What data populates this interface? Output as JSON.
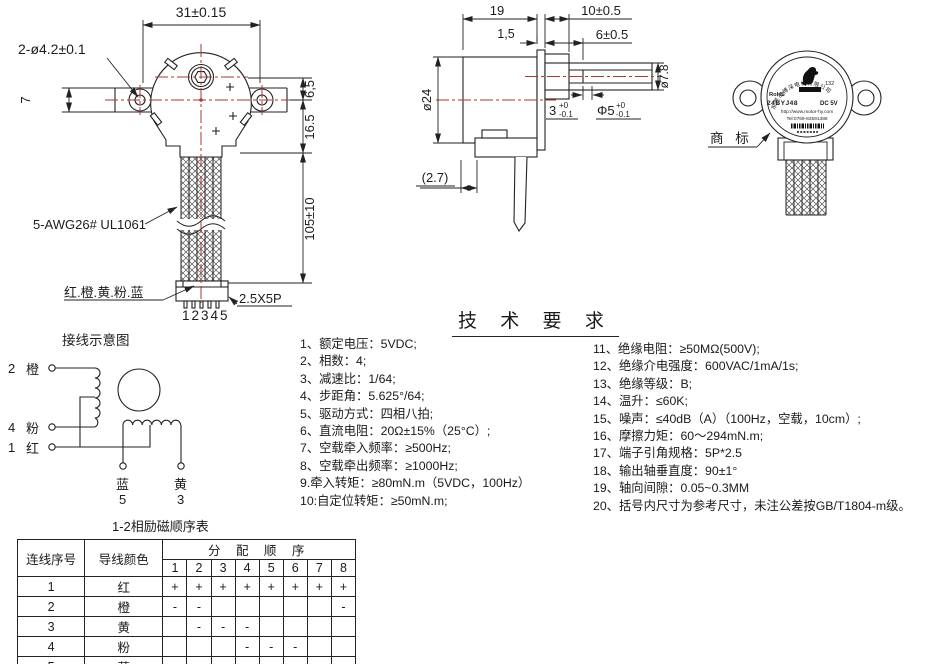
{
  "front_view": {
    "dim_width_top": "31±0.15",
    "dim_holes": "2-ø4.2±0.1",
    "dim_bracket_h": "7",
    "dim_shaft_offset": "6,5",
    "dim_body_h": "16.5",
    "dim_wire_len": "105±10",
    "wire_spec": "5-AWG26# UL1061",
    "wire_colors": "红.橙.黄.粉.蓝",
    "pin_numbers": "12345",
    "connector_spec": "2.5X5P"
  },
  "side_view": {
    "dim_body_w": "19",
    "dim_plate": "1,5",
    "dim_shaft_len": "10±0.5",
    "dim_flat_len": "6±0.5",
    "dim_body_d": "ø24",
    "dim_boss_d": "ø7.8",
    "dim_step": "3",
    "dim_step_tol_hi": "+0",
    "dim_step_tol_lo": "-0.1",
    "dim_shaft_d": "Φ5",
    "dim_shaft_d_tol_hi": "+0",
    "dim_shaft_d_tol_lo": "-0.1",
    "dim_ref": "(2.7)"
  },
  "rear_view": {
    "company_arc": "东莞市博深电机有限公司",
    "rohs": "RoHS",
    "logo_num": "132",
    "model": "24BYJ48",
    "voltage": "DC 5V",
    "url": "http://www.motor-hy.com",
    "tel": "Tel:0769-82591388",
    "trademark": "商 标"
  },
  "wiring": {
    "title": "接线示意图",
    "t2": {
      "num": "2",
      "color": "橙"
    },
    "t4": {
      "num": "4",
      "color": "粉"
    },
    "t1": {
      "num": "1",
      "color": "红"
    },
    "t5": {
      "color": "蓝",
      "num": "5"
    },
    "t3": {
      "color": "黄",
      "num": "3"
    }
  },
  "tech": {
    "title": "技 术 要 求",
    "items_left": [
      "1、额定电压：5VDC;",
      "2、相数：4;",
      "3、减速比：1/64;",
      "4、步距角：5.625°/64;",
      "5、驱动方式：四相八拍;",
      "6、直流电阻：20Ω±15%（25°C）;",
      "7、空载牵入频率：≥500Hz;",
      "8、空载牵出频率：≥1000Hz;",
      "9.牵入转矩：≥80mN.m（5VDC，100Hz）",
      "10:自定位转矩：≥50mN.m;"
    ],
    "items_right": [
      "11、绝缘电阻：≥50MΩ(500V);",
      "12、绝缘介电强度：600VAC/1mA/1s;",
      "13、绝缘等级：B;",
      "14、温升：≤60K;",
      "15、噪声：≤40dB（A）（100Hz，空载，10cm）;",
      "16、摩擦力矩：60～294mN.m;",
      "17、端子引角规格：5P*2.5",
      "18、输出轴垂直度：90±1°",
      "19、轴向间隙：0.05~0.3MM",
      "20、括号内尺寸为参考尺寸，未注公差按GB/T1804-m级。"
    ]
  },
  "sequence_table": {
    "title": "1-2相励磁顺序表",
    "col_wire_no": "连线序号",
    "col_wire_color": "导线颜色",
    "col_sequence": "分 配 顺 序",
    "steps": [
      "1",
      "2",
      "3",
      "4",
      "5",
      "6",
      "7",
      "8"
    ],
    "rows": [
      {
        "no": "1",
        "color": "红",
        "cells": [
          "+",
          "+",
          "+",
          "+",
          "+",
          "+",
          "+",
          "+"
        ]
      },
      {
        "no": "2",
        "color": "橙",
        "cells": [
          "-",
          "-",
          "",
          "",
          "",
          "",
          "",
          "-"
        ]
      },
      {
        "no": "3",
        "color": "黄",
        "cells": [
          "",
          "-",
          "-",
          "-",
          "",
          "",
          "",
          ""
        ]
      },
      {
        "no": "4",
        "color": "粉",
        "cells": [
          "",
          "",
          "",
          "-",
          "-",
          "-",
          "",
          ""
        ]
      },
      {
        "no": "5",
        "color": "蓝",
        "cells": [
          "",
          "",
          "",
          "",
          "",
          "-",
          "-",
          "-"
        ]
      }
    ]
  },
  "colors": {
    "line": "#222222",
    "centerline": "#a63a34",
    "rohs_green": "#1fae4b"
  }
}
